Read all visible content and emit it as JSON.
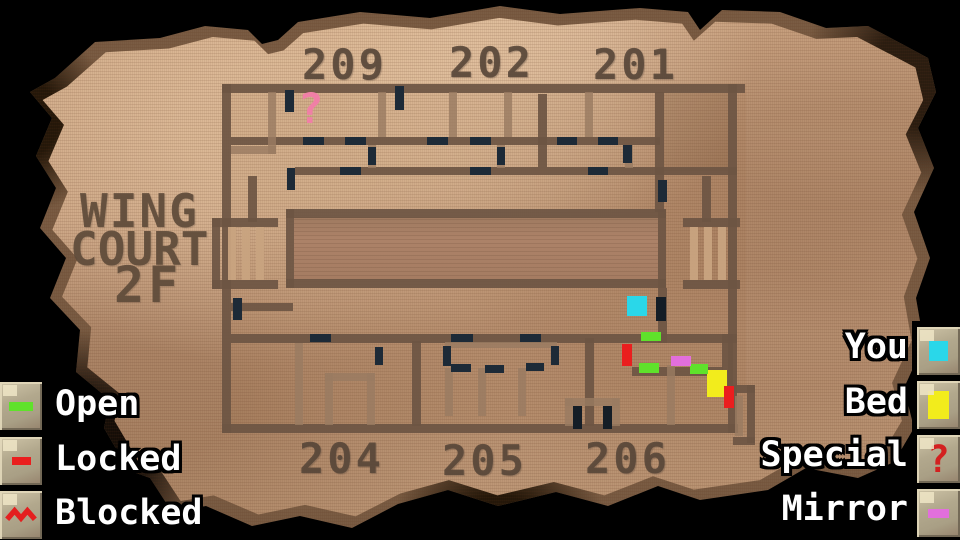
{
  "screen": {
    "name": "dungeon-floor-map"
  },
  "title": {
    "line1": "WING",
    "line2": "COURT",
    "line3": "2F"
  },
  "rooms": {
    "top": [
      "209",
      "202",
      "201"
    ],
    "bottom": [
      "204",
      "205",
      "206"
    ]
  },
  "legend_left": [
    {
      "label": "Open",
      "icon": "open-door-dash",
      "color": "#5fe22b"
    },
    {
      "label": "Locked",
      "icon": "locked-door-dash",
      "color": "#ea1e1e"
    },
    {
      "label": "Blocked",
      "icon": "blocked-zigzag",
      "color": "#e41f1f"
    }
  ],
  "legend_right": [
    {
      "label": "You",
      "icon": "you-square",
      "color": "#2ad7e9"
    },
    {
      "label": "Bed",
      "icon": "bed-square",
      "color": "#f2ec1c"
    },
    {
      "label": "Special",
      "icon": "question-mark",
      "color": "#d32020",
      "symbol": "?"
    },
    {
      "label": "Mirror",
      "icon": "mirror-dash",
      "color": "#e26fdc"
    }
  ],
  "map": {
    "special_marker": {
      "symbol": "?",
      "color": "#f07fa6",
      "x": 298,
      "y": 88
    },
    "markers": [
      {
        "type": "you-marker",
        "x": 627,
        "y": 296,
        "w": 20,
        "h": 20,
        "color": "#2ad7e9"
      },
      {
        "type": "bed-marker",
        "x": 707,
        "y": 370,
        "w": 20,
        "h": 27,
        "color": "#f2ec1c"
      },
      {
        "type": "open-door",
        "x": 641,
        "y": 332,
        "w": 20,
        "h": 9,
        "color": "#5fe22b"
      },
      {
        "type": "open-door",
        "x": 639,
        "y": 363,
        "w": 20,
        "h": 10,
        "color": "#5fe22b"
      },
      {
        "type": "open-door",
        "x": 690,
        "y": 364,
        "w": 18,
        "h": 10,
        "color": "#5fe22b"
      },
      {
        "type": "locked-door",
        "x": 622,
        "y": 344,
        "w": 10,
        "h": 22,
        "color": "#ea1e1e"
      },
      {
        "type": "locked-door",
        "x": 724,
        "y": 386,
        "w": 10,
        "h": 22,
        "color": "#ea1e1e"
      },
      {
        "type": "mirror-marker",
        "x": 671,
        "y": 356,
        "w": 20,
        "h": 10,
        "color": "#e26fdc"
      }
    ],
    "doors": [
      [
        285,
        90,
        9,
        22
      ],
      [
        395,
        86,
        9,
        24
      ],
      [
        303,
        137,
        21,
        8
      ],
      [
        345,
        137,
        21,
        8
      ],
      [
        427,
        137,
        21,
        8
      ],
      [
        470,
        137,
        21,
        8
      ],
      [
        557,
        137,
        20,
        8
      ],
      [
        598,
        137,
        20,
        8
      ],
      [
        340,
        167,
        21,
        8
      ],
      [
        470,
        167,
        21,
        8
      ],
      [
        588,
        167,
        20,
        8
      ],
      [
        368,
        147,
        8,
        18
      ],
      [
        497,
        147,
        8,
        18
      ],
      [
        623,
        145,
        9,
        18
      ],
      [
        287,
        168,
        8,
        22
      ],
      [
        658,
        180,
        9,
        22
      ],
      [
        233,
        298,
        9,
        22
      ],
      [
        310,
        334,
        21,
        8
      ],
      [
        451,
        334,
        22,
        8
      ],
      [
        520,
        334,
        21,
        8
      ],
      [
        443,
        346,
        8,
        20
      ],
      [
        551,
        346,
        8,
        19
      ],
      [
        451,
        364,
        20,
        8
      ],
      [
        485,
        365,
        19,
        8
      ],
      [
        526,
        363,
        18,
        8
      ],
      [
        375,
        347,
        8,
        18
      ]
    ],
    "dark_doors": [
      [
        656,
        297,
        10,
        24
      ],
      [
        573,
        406,
        9,
        23
      ],
      [
        603,
        406,
        9,
        23
      ]
    ]
  }
}
